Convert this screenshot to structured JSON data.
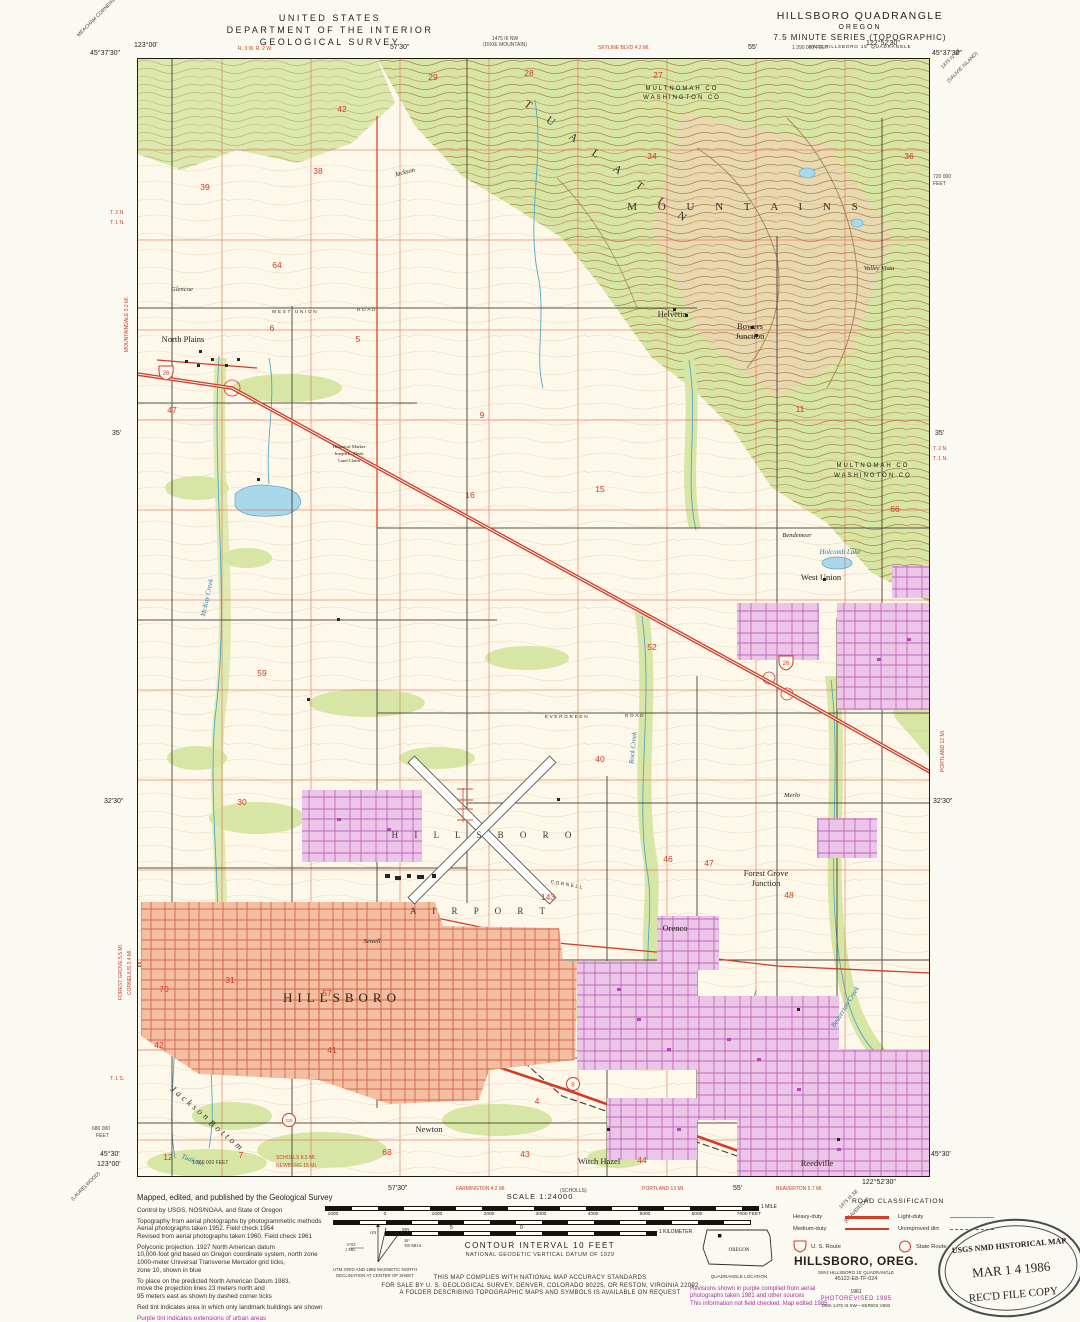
{
  "header": {
    "agency1": "UNITED STATES",
    "agency2": "DEPARTMENT OF THE INTERIOR",
    "agency3": "GEOLOGICAL SURVEY",
    "quad1": "HILLSBORO QUADRANGLE",
    "quad2": "OREGON",
    "quad3": "7.5 MINUTE SERIES (TOPOGRAPHIC)",
    "quad4": "SW/4 HILLSBORO 15' QUADRANGLE"
  },
  "colors": {
    "highway_red": "#d43a26",
    "urban_salmon": "#f3bfa3",
    "urban_purple": "#ecc6e8",
    "woodland_green": "#d7e6a4",
    "water_blue": "#a8d8ea",
    "contour_brown": "#a97b45",
    "purple_ink": "#a832a0"
  },
  "map": {
    "labels": [
      {
        "t": "North Plains",
        "x": 46,
        "y": 284,
        "c": "town"
      },
      {
        "t": "Glencoe",
        "x": 45,
        "y": 233,
        "c": "small"
      },
      {
        "t": "Helvetia",
        "x": 535,
        "y": 259,
        "c": "town"
      },
      {
        "t": "Bowers",
        "x": 613,
        "y": 271,
        "c": "town"
      },
      {
        "t": "Junction",
        "x": 613,
        "y": 281,
        "c": "town"
      },
      {
        "t": "West Union",
        "x": 684,
        "y": 522,
        "c": "town"
      },
      {
        "t": "Bendemeer",
        "x": 660,
        "y": 479,
        "c": "small"
      },
      {
        "t": "Holcomb Lake",
        "x": 703,
        "y": 496,
        "c": "water"
      },
      {
        "t": "MULTNOMAH  CO",
        "x": 545,
        "y": 32,
        "c": "county"
      },
      {
        "t": "WASHINGTON  CO",
        "x": 545,
        "y": 41,
        "c": "county"
      },
      {
        "t": "MULTNOMAH  CO",
        "x": 736,
        "y": 409,
        "c": "county"
      },
      {
        "t": "WASHINGTON  CO",
        "x": 736,
        "y": 419,
        "c": "county"
      },
      {
        "t": "T U A L A T I N",
        "x": 470,
        "y": 108,
        "c": "range",
        "rot": 36
      },
      {
        "t": "M O U N T A I N S",
        "x": 610,
        "y": 152,
        "c": "range"
      },
      {
        "t": "Valley Vista",
        "x": 742,
        "y": 212,
        "c": "small"
      },
      {
        "t": "Historical Marker",
        "x": 212,
        "y": 390,
        "c": "tiny"
      },
      {
        "t": "Joseph L. Meek",
        "x": 212,
        "y": 397,
        "c": "tiny"
      },
      {
        "t": "Land Claim",
        "x": 212,
        "y": 404,
        "c": "tiny"
      },
      {
        "t": "H I L L S B O R O",
        "x": 348,
        "y": 780,
        "c": "airport"
      },
      {
        "t": "A I R P O R T",
        "x": 344,
        "y": 856,
        "c": "airport"
      },
      {
        "t": "HILLSBORO",
        "x": 205,
        "y": 944,
        "c": "city"
      },
      {
        "t": "Sewell",
        "x": 235,
        "y": 885,
        "c": "small"
      },
      {
        "t": "Orenco",
        "x": 538,
        "y": 873,
        "c": "town"
      },
      {
        "t": "Forest Grove",
        "x": 629,
        "y": 818,
        "c": "town"
      },
      {
        "t": "Junction",
        "x": 629,
        "y": 828,
        "c": "town"
      },
      {
        "t": "Merlo",
        "x": 655,
        "y": 739,
        "c": "small"
      },
      {
        "t": "Newton",
        "x": 292,
        "y": 1074,
        "c": "town"
      },
      {
        "t": "Witch Hazel",
        "x": 462,
        "y": 1106,
        "c": "town"
      },
      {
        "t": "Reedville",
        "x": 680,
        "y": 1108,
        "c": "town"
      },
      {
        "t": "Jackson",
        "x": 52,
        "y": 1048,
        "c": "bottomland",
        "rot": 40
      },
      {
        "t": "Bottom",
        "x": 88,
        "y": 1080,
        "c": "bottomland",
        "rot": 40
      },
      {
        "t": "WEST  UNION",
        "x": 158,
        "y": 255,
        "c": "road"
      },
      {
        "t": "ROAD",
        "x": 230,
        "y": 253,
        "c": "road"
      },
      {
        "t": "EVERGREEN",
        "x": 430,
        "y": 660,
        "c": "road"
      },
      {
        "t": "ROAD",
        "x": 498,
        "y": 659,
        "c": "road"
      },
      {
        "t": "CORNELL",
        "x": 430,
        "y": 828,
        "c": "road",
        "rot": 10
      },
      {
        "t": "McKay Creek",
        "x": 72,
        "y": 540,
        "c": "water",
        "rot": -78
      },
      {
        "t": "Rock Creek",
        "x": 498,
        "y": 690,
        "c": "water",
        "rot": -84
      },
      {
        "t": "Beaverton Creek",
        "x": 710,
        "y": 950,
        "c": "water",
        "rot": -58
      },
      {
        "t": "Tualatin",
        "x": 55,
        "y": 1104,
        "c": "water",
        "rot": 20
      },
      {
        "t": "Jackson",
        "x": 268,
        "y": 116,
        "c": "small",
        "rot": -14
      }
    ],
    "section_numbers": [
      {
        "n": "29",
        "x": 296,
        "y": 22
      },
      {
        "n": "28",
        "x": 392,
        "y": 18
      },
      {
        "n": "27",
        "x": 521,
        "y": 20
      },
      {
        "n": "34",
        "x": 515,
        "y": 101
      },
      {
        "n": "36",
        "x": 772,
        "y": 101
      },
      {
        "n": "42",
        "x": 205,
        "y": 54
      },
      {
        "n": "38",
        "x": 181,
        "y": 116
      },
      {
        "n": "39",
        "x": 68,
        "y": 132
      },
      {
        "n": "64",
        "x": 140,
        "y": 210
      },
      {
        "n": "6",
        "x": 135,
        "y": 273
      },
      {
        "n": "5",
        "x": 221,
        "y": 284
      },
      {
        "n": "9",
        "x": 345,
        "y": 360
      },
      {
        "n": "11",
        "x": 663,
        "y": 354
      },
      {
        "n": "47",
        "x": 35,
        "y": 355
      },
      {
        "n": "16",
        "x": 333,
        "y": 440
      },
      {
        "n": "15",
        "x": 463,
        "y": 434
      },
      {
        "n": "66",
        "x": 758,
        "y": 454
      },
      {
        "n": "59",
        "x": 125,
        "y": 618
      },
      {
        "n": "52",
        "x": 515,
        "y": 592
      },
      {
        "n": "40",
        "x": 463,
        "y": 704
      },
      {
        "n": "30",
        "x": 105,
        "y": 747
      },
      {
        "n": "46",
        "x": 531,
        "y": 804
      },
      {
        "n": "47",
        "x": 572,
        "y": 808
      },
      {
        "n": "48",
        "x": 652,
        "y": 840
      },
      {
        "n": "31",
        "x": 93,
        "y": 925
      },
      {
        "n": "70",
        "x": 27,
        "y": 934
      },
      {
        "n": "57",
        "x": 190,
        "y": 938
      },
      {
        "n": "41",
        "x": 195,
        "y": 995
      },
      {
        "n": "42",
        "x": 22,
        "y": 990
      },
      {
        "n": "43",
        "x": 388,
        "y": 1099
      },
      {
        "n": "44",
        "x": 505,
        "y": 1105
      },
      {
        "n": "68",
        "x": 250,
        "y": 1097
      },
      {
        "n": "4",
        "x": 400,
        "y": 1046
      },
      {
        "n": "12",
        "x": 31,
        "y": 1102
      },
      {
        "n": "7",
        "x": 104,
        "y": 1100
      },
      {
        "n": "143",
        "x": 411,
        "y": 842
      }
    ],
    "margin_labels": [
      {
        "t": "123°00'",
        "x": 134,
        "y": 42
      },
      {
        "t": "45°37'30\"",
        "x": 90,
        "y": 50
      },
      {
        "t": "R. 3 W.  R. 2 W.",
        "x": 238,
        "y": 46,
        "c": "redtiny"
      },
      {
        "t": "57'30\"",
        "x": 390,
        "y": 44
      },
      {
        "t": "1475 III NW",
        "x": 505,
        "y": 36,
        "c": "tiny",
        "a": "center"
      },
      {
        "t": "(DIXIE MOUNTAIN)",
        "x": 505,
        "y": 42,
        "c": "tiny",
        "a": "center"
      },
      {
        "t": "SKYLINE BLVD 4.2 MI.",
        "x": 598,
        "y": 45,
        "c": "redtiny"
      },
      {
        "t": "55'",
        "x": 748,
        "y": 44
      },
      {
        "t": "1 390 000 FEET",
        "x": 792,
        "y": 45,
        "c": "tiny"
      },
      {
        "t": "122°52'30\"",
        "x": 866,
        "y": 40
      },
      {
        "t": "45°37'30\"",
        "x": 932,
        "y": 50
      },
      {
        "t": "MEACHAM CORNERS",
        "x": 76,
        "y": 34,
        "rot": -45,
        "c": "tiny"
      },
      {
        "t": "1475 IV NE",
        "x": 940,
        "y": 66,
        "rot": -45,
        "c": "tiny"
      },
      {
        "t": "(SAUVIE ISLAND)",
        "x": 946,
        "y": 80,
        "rot": -45,
        "c": "tiny"
      },
      {
        "t": "T. 2 N.",
        "x": 110,
        "y": 210,
        "c": "redtiny"
      },
      {
        "t": "T. 1 N.",
        "x": 110,
        "y": 220,
        "c": "redtiny"
      },
      {
        "t": "MOUNTAINDALE 5.2 MI.",
        "x": 124,
        "y": 352,
        "rot": -90,
        "c": "redtiny"
      },
      {
        "t": "35'",
        "x": 112,
        "y": 430
      },
      {
        "t": "32'30\"",
        "x": 104,
        "y": 798
      },
      {
        "t": "FOREST GROVE 5.5 MI.",
        "x": 118,
        "y": 1000,
        "rot": -90,
        "c": "redtiny"
      },
      {
        "t": "CORNELIUS 3.4 MI.",
        "x": 127,
        "y": 995,
        "rot": -90,
        "c": "redtiny"
      },
      {
        "t": "T. 1 S.",
        "x": 110,
        "y": 1076,
        "c": "redtiny"
      },
      {
        "t": "680 000",
        "x": 92,
        "y": 1126,
        "c": "tiny"
      },
      {
        "t": "FEET",
        "x": 96,
        "y": 1133,
        "c": "tiny"
      },
      {
        "t": "720 000",
        "x": 933,
        "y": 174,
        "c": "tiny"
      },
      {
        "t": "FEET",
        "x": 933,
        "y": 181,
        "c": "tiny"
      },
      {
        "t": "35'",
        "x": 935,
        "y": 430
      },
      {
        "t": "T. 2 N.",
        "x": 933,
        "y": 446,
        "c": "redtiny"
      },
      {
        "t": "T. 1 N.",
        "x": 933,
        "y": 456,
        "c": "redtiny"
      },
      {
        "t": "PORTLAND 12 MI.",
        "x": 940,
        "y": 772,
        "rot": -90,
        "c": "redtiny"
      },
      {
        "t": "32'30\"",
        "x": 933,
        "y": 798
      },
      {
        "t": "45°30'",
        "x": 100,
        "y": 1151
      },
      {
        "t": "123°00'",
        "x": 97,
        "y": 1161
      },
      {
        "t": "1 360 000 FEET",
        "x": 192,
        "y": 1160,
        "c": "tiny"
      },
      {
        "t": "SCHOLLS 8.5 MI.",
        "x": 276,
        "y": 1155,
        "c": "redtiny"
      },
      {
        "t": "NEWBERG 15 MI.",
        "x": 276,
        "y": 1163,
        "c": "redtiny"
      },
      {
        "t": "(LAURELWOOD)",
        "x": 70,
        "y": 1198,
        "rot": -45,
        "c": "tiny"
      },
      {
        "t": "57'30\"",
        "x": 388,
        "y": 1185
      },
      {
        "t": "FARMINGTON 4.2 MI.",
        "x": 456,
        "y": 1186,
        "c": "redtiny"
      },
      {
        "t": "(SCHOLLS)",
        "x": 560,
        "y": 1188,
        "c": "tiny"
      },
      {
        "t": "PORTLAND 13 MI.",
        "x": 642,
        "y": 1186,
        "c": "redtiny"
      },
      {
        "t": "55'",
        "x": 733,
        "y": 1185
      },
      {
        "t": "BEAVERTON 5.7 MI.",
        "x": 776,
        "y": 1186,
        "c": "redtiny"
      },
      {
        "t": "122°52'30\"",
        "x": 862,
        "y": 1179
      },
      {
        "t": "45°30'",
        "x": 931,
        "y": 1151
      },
      {
        "t": "1475 III SE",
        "x": 838,
        "y": 1206,
        "rot": -45,
        "c": "tiny"
      },
      {
        "t": "(BEAVERTON)",
        "x": 843,
        "y": 1220,
        "rot": -45,
        "c": "tiny"
      }
    ],
    "route_markers": {
      "us26a": "26",
      "us26b": "26",
      "sr8": "8",
      "sr219": "219"
    }
  },
  "footer": {
    "credits": [
      {
        "t": "Mapped, edited, and published by the Geological Survey",
        "c": "c-lg"
      },
      {
        "t": "Control by USGS, NOS/NOAA, and State of Oregon",
        "c": "c-sm gap"
      },
      {
        "t": "Topography from aerial photographs by photogrammetric methods",
        "c": "c-sm gap"
      },
      {
        "t": "Aerial photographs taken 1952.    Field check 1954",
        "c": "c-sm"
      },
      {
        "t": "Revised from aerial photographs taken 1960.    Field check 1961",
        "c": "c-sm"
      },
      {
        "t": "Polyconic projection.    1927 North American datum",
        "c": "c-sm gap"
      },
      {
        "t": "10,000-foot grid based on Oregon coordinate system, north zone",
        "c": "c-sm"
      },
      {
        "t": "1000-meter Universal Transverse Mercator grid ticks,",
        "c": "c-sm"
      },
      {
        "t": "zone 10, shown in blue",
        "c": "c-sm"
      },
      {
        "t": "To place on the predicted North American Datum 1983,",
        "c": "c-sm gap"
      },
      {
        "t": "move the projection lines 23 meters north and",
        "c": "c-sm"
      },
      {
        "t": "95 meters east as shown by dashed corner ticks",
        "c": "c-sm"
      },
      {
        "t": "Red tint indicates area in which only landmark buildings are shown",
        "c": "c-sm gap"
      },
      {
        "t": "Purple tint indicates extensions of urban areas",
        "c": "c-purple gap"
      }
    ],
    "declination": {
      "cap1": "UTM GRID AND 1985 MAGNETIC NORTH",
      "cap2": "DECLINATION AT CENTER OF SHEET",
      "utm_deg": "0°02'",
      "utm_mil": "1 MIL",
      "mag_deg": "20°",
      "mag_mil": "356 MILS",
      "gn": "GN",
      "mn": "MN"
    },
    "scale": {
      "title": "SCALE 1:24000",
      "mile": "1 MILE",
      "km": "1 KILOMETER",
      "km_half": "5",
      "km_zero": "0",
      "feet_ticks": [
        {
          "t": "1000",
          "x": 8
        },
        {
          "t": "0",
          "x": 60
        },
        {
          "t": "1000",
          "x": 112
        },
        {
          "t": "2000",
          "x": 164
        },
        {
          "t": "3000",
          "x": 216
        },
        {
          "t": "4000",
          "x": 268
        },
        {
          "t": "5000",
          "x": 320
        },
        {
          "t": "6000",
          "x": 372
        },
        {
          "t": "7000 FEET",
          "x": 424
        }
      ],
      "contour": "CONTOUR INTERVAL 10 FEET",
      "datum": "NATIONAL GEODETIC VERTICAL DATUM OF 1929"
    },
    "accuracy": [
      "THIS MAP COMPLIES WITH NATIONAL MAP ACCURACY STANDARDS",
      "FOR SALE BY U. S. GEOLOGICAL SURVEY, DENVER, COLORADO 80225, OR RESTON, VIRGINIA 22092",
      "A FOLDER DESCRIBING TOPOGRAPHIC MAPS AND SYMBOLS IS AVAILABLE ON REQUEST"
    ],
    "road_classification": {
      "title": "ROAD CLASSIFICATION",
      "rows": [
        {
          "label": "Heavy-duty",
          "style": "heavy"
        },
        {
          "label": "Light-duty",
          "style": "light"
        },
        {
          "label": "Medium-duty",
          "style": "medium"
        },
        {
          "label": "Unimproved dirt",
          "style": "dirt"
        }
      ],
      "us_route": "U. S. Route",
      "state_route": "State Route"
    },
    "quadrangle_location": {
      "state": "OREGON",
      "caption": "QUADRANGLE LOCATION"
    },
    "revision_note": [
      "Revisions shown in purple compiled from aerial",
      "photographs taken 1981 and other sources",
      "This information not field checked.   Map edited 1985"
    ],
    "title_block": {
      "name": "HILLSBORO, OREG.",
      "sub": "SW/4 HILLSBORO 15' QUADRANGLE",
      "code": "45122-E8-TF-024",
      "year": "1961",
      "photorev": "PHOTOREVISED 1985",
      "dma": "DMA 1475 III SW—SERIES V892"
    },
    "stamp": {
      "l1": "USGS NMD HISTORICAL MAP",
      "l2": "MAR 1 4 1986",
      "l3": "REC'D FILE COPY"
    }
  }
}
